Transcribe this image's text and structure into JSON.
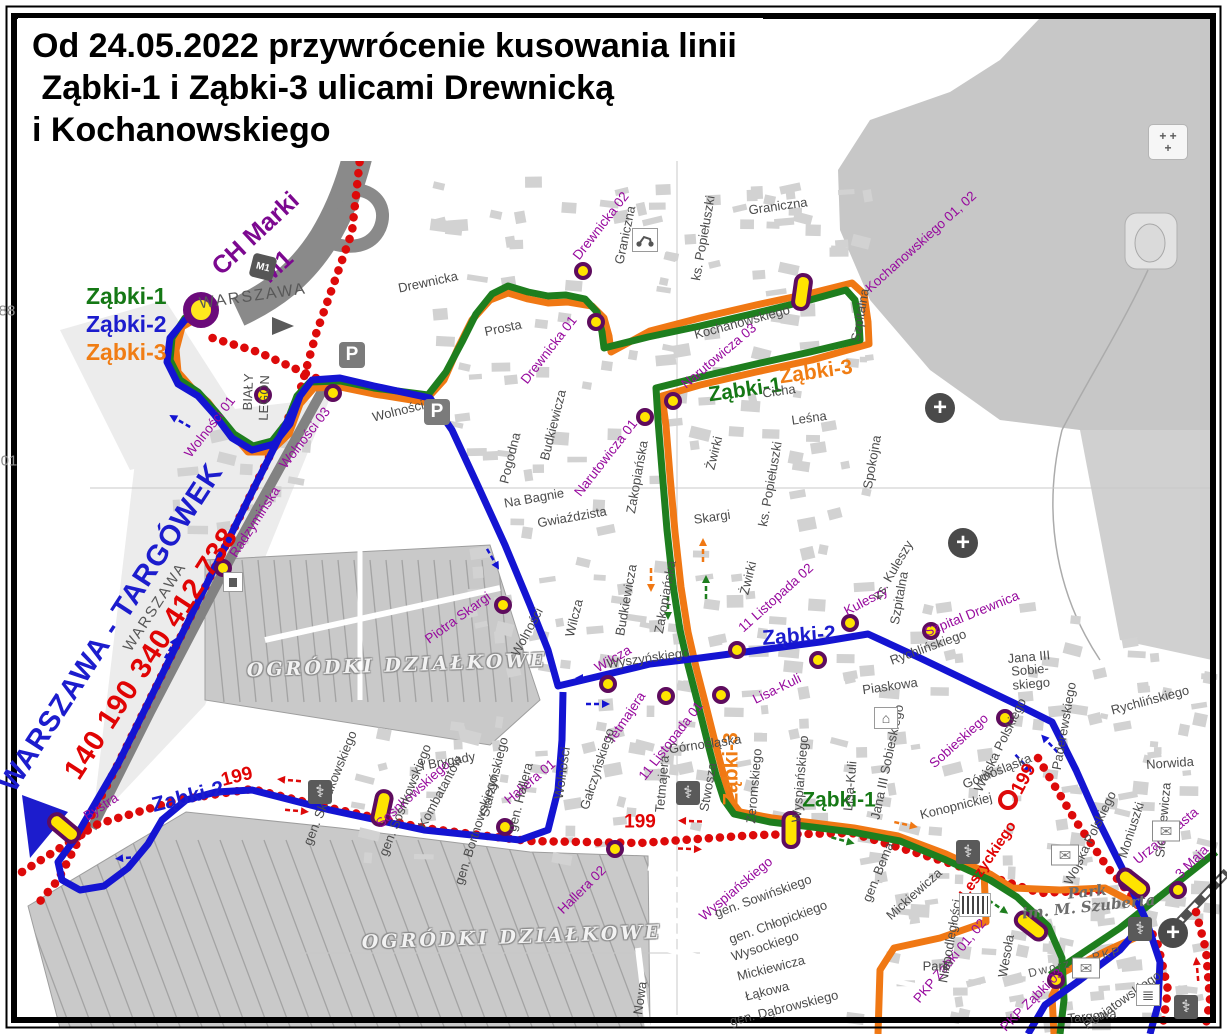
{
  "title": {
    "line1": "Od 24.05.2022 przywrócenie kusowania linii",
    "line2": " Ząbki-1 i Ząbki-3 ulicami Drewnicką",
    "line3": "i Kochanowskiego"
  },
  "legend": {
    "items": [
      {
        "label": "Ząbki-1",
        "color": "#157815"
      },
      {
        "label": "Ząbki-2",
        "color": "#1c1ccd"
      },
      {
        "label": "Ząbki-3",
        "color": "#f07d14"
      }
    ]
  },
  "colors": {
    "zabki1_green": "#1e7e1e",
    "zabki2_blue": "#1414d2",
    "zabki3_orange": "#f07814",
    "line199_red": "#dd0a0a",
    "stop_fill": "#ffe400",
    "stop_ring": "#5e0c5e",
    "terminal_fill": "#ffe81e",
    "terminal_ring": "#6b0b7b",
    "street_label": "#4b4b4b",
    "stop_label_purple": "#970a9e"
  },
  "map": {
    "labels": [
      {
        "t": "CH Marki",
        "x": 256,
        "y": 234,
        "r": -43,
        "c": "pub"
      },
      {
        "t": "M1",
        "x": 277,
        "y": 267,
        "r": -43,
        "c": "pub"
      },
      {
        "t": "WARSZAWA",
        "x": 253,
        "y": 297,
        "r": -8,
        "c": "dark"
      },
      {
        "t": "WARSZAWA",
        "x": 155,
        "y": 607,
        "r": -57,
        "c": "dark",
        "s": 15
      },
      {
        "t": "WARSZAWA - TARGÓWEK",
        "x": 112,
        "y": 628,
        "r": -57,
        "c": "bb"
      },
      {
        "t": "140 190 340 412 738",
        "x": 152,
        "y": 654,
        "r": -57,
        "c": "rb"
      },
      {
        "t": "Ząbki-2",
        "x": 188,
        "y": 797,
        "r": -14,
        "c": "bm"
      },
      {
        "t": "199",
        "x": 237,
        "y": 777,
        "r": -14,
        "c": "rm"
      },
      {
        "t": "Bystra",
        "x": 101,
        "y": 807,
        "r": -33,
        "c": "pu"
      },
      {
        "t": "199",
        "x": 640,
        "y": 822,
        "r": 0,
        "c": "rm"
      },
      {
        "t": "199",
        "x": 1024,
        "y": 779,
        "r": -62,
        "c": "rm"
      },
      {
        "t": "Ząbki-1",
        "x": 745,
        "y": 390,
        "r": -8,
        "c": "gm"
      },
      {
        "t": "Ząbki-3",
        "x": 816,
        "y": 372,
        "r": -8,
        "c": "om"
      },
      {
        "t": "Ząbki-2",
        "x": 799,
        "y": 636,
        "r": -4,
        "c": "bm"
      },
      {
        "t": "Ząbki-1",
        "x": 839,
        "y": 800,
        "r": 0,
        "c": "gm"
      },
      {
        "t": "Ząbki-3",
        "x": 731,
        "y": 769,
        "r": -90,
        "c": "om"
      },
      {
        "t": "Leszyckiego",
        "x": 988,
        "y": 860,
        "r": -56,
        "c": "rs"
      },
      {
        "t": "OGRÓDKI DZIAŁKOWE",
        "x": 397,
        "y": 666,
        "r": -2,
        "c": "area"
      },
      {
        "t": "OGRÓDKI DZIAŁKOWE",
        "x": 512,
        "y": 938,
        "r": -2,
        "c": "area"
      },
      {
        "t": "Park\nim. M. Szuberta",
        "x": 1088,
        "y": 900,
        "r": -6,
        "c": "park"
      },
      {
        "t": "Dworzec PKP",
        "x": 1075,
        "y": 962,
        "r": -14,
        "c": "dark",
        "s": 12
      },
      {
        "t": "88",
        "x": 7,
        "y": 311,
        "r": 0,
        "c": "grid"
      },
      {
        "t": "01",
        "x": 9,
        "y": 461,
        "r": 0,
        "c": "grid"
      },
      {
        "t": "BIAŁY",
        "x": 248,
        "y": 392,
        "r": -88,
        "c": "st"
      },
      {
        "t": "LEGON",
        "x": 264,
        "y": 398,
        "r": -88,
        "c": "st"
      },
      {
        "t": "Drewnicka 02",
        "x": 601,
        "y": 226,
        "r": -52,
        "c": "pu"
      },
      {
        "t": "Drewnicka 01",
        "x": 549,
        "y": 350,
        "r": -52,
        "c": "pu"
      },
      {
        "t": "Kochanowskiego 01, 02",
        "x": 921,
        "y": 242,
        "r": -42,
        "c": "pu"
      },
      {
        "t": "Narutowicza 03",
        "x": 719,
        "y": 356,
        "r": -40,
        "c": "pu"
      },
      {
        "t": "Narutowicza 01",
        "x": 606,
        "y": 458,
        "r": -52,
        "c": "pu"
      },
      {
        "t": "Wolności 01",
        "x": 210,
        "y": 427,
        "r": -52,
        "c": "pu"
      },
      {
        "t": "Wolności 03",
        "x": 305,
        "y": 438,
        "r": -52,
        "c": "pu"
      },
      {
        "t": "Radzymińska",
        "x": 255,
        "y": 522,
        "r": -57,
        "c": "pu"
      },
      {
        "t": "Piotra Skargi",
        "x": 458,
        "y": 618,
        "r": -36,
        "c": "pu"
      },
      {
        "t": "11 Listopada 02",
        "x": 776,
        "y": 598,
        "r": -42,
        "c": "pu"
      },
      {
        "t": "11 Listopada 01",
        "x": 671,
        "y": 741,
        "r": -52,
        "c": "pu"
      },
      {
        "t": "Wilcza",
        "x": 613,
        "y": 659,
        "r": -30,
        "c": "pu"
      },
      {
        "t": "Tetmajera",
        "x": 626,
        "y": 718,
        "r": -56,
        "c": "pu"
      },
      {
        "t": "Lisa-Kuli",
        "x": 777,
        "y": 689,
        "r": -26,
        "c": "pu"
      },
      {
        "t": "Kuleszy",
        "x": 866,
        "y": 601,
        "r": -28,
        "c": "pu"
      },
      {
        "t": "Szpital Drewnica",
        "x": 972,
        "y": 614,
        "r": -22,
        "c": "pu"
      },
      {
        "t": "Sobieskiego",
        "x": 959,
        "y": 741,
        "r": -42,
        "c": "pu"
      },
      {
        "t": "Sosnkowskiego",
        "x": 413,
        "y": 794,
        "r": -42,
        "c": "pu"
      },
      {
        "t": "Hallera 01",
        "x": 530,
        "y": 782,
        "r": -40,
        "c": "pu"
      },
      {
        "t": "Hallera 02",
        "x": 582,
        "y": 890,
        "r": -45,
        "c": "pu"
      },
      {
        "t": "Wyspiańskiego",
        "x": 736,
        "y": 889,
        "r": -40,
        "c": "pu"
      },
      {
        "t": "PKP Zabki 01, 02",
        "x": 950,
        "y": 961,
        "r": -50,
        "c": "pu"
      },
      {
        "t": "PKP Ząbki 03",
        "x": 1032,
        "y": 1000,
        "r": -45,
        "c": "pu"
      },
      {
        "t": "Urząd Miasta",
        "x": 1166,
        "y": 836,
        "r": -40,
        "c": "pu"
      },
      {
        "t": "3 Maja",
        "x": 1192,
        "y": 862,
        "r": -45,
        "c": "pu"
      },
      {
        "t": "Drewnicka",
        "x": 428,
        "y": 282,
        "r": -12,
        "c": "st"
      },
      {
        "t": "Prosta",
        "x": 503,
        "y": 328,
        "r": -12,
        "c": "st"
      },
      {
        "t": "Graniczna",
        "x": 625,
        "y": 235,
        "r": -78,
        "c": "st"
      },
      {
        "t": "Graniczna",
        "x": 778,
        "y": 206,
        "r": -8,
        "c": "st"
      },
      {
        "t": "ks. Popiełuszki",
        "x": 703,
        "y": 238,
        "r": -80,
        "c": "st"
      },
      {
        "t": "Kochanowskiego",
        "x": 742,
        "y": 322,
        "r": -15,
        "c": "st"
      },
      {
        "t": "Szpitalna",
        "x": 860,
        "y": 315,
        "r": -80,
        "c": "st"
      },
      {
        "t": "Cicha",
        "x": 779,
        "y": 391,
        "r": -8,
        "c": "st"
      },
      {
        "t": "Leśna",
        "x": 809,
        "y": 418,
        "r": -8,
        "c": "st"
      },
      {
        "t": "Spokojna",
        "x": 872,
        "y": 462,
        "r": -80,
        "c": "st"
      },
      {
        "t": "Żwirki",
        "x": 714,
        "y": 453,
        "r": -76,
        "c": "st"
      },
      {
        "t": "Żwirki",
        "x": 748,
        "y": 578,
        "r": -76,
        "c": "st"
      },
      {
        "t": "ks. Popiełuszki",
        "x": 770,
        "y": 484,
        "r": -80,
        "c": "st"
      },
      {
        "t": "Skargi",
        "x": 712,
        "y": 517,
        "r": -8,
        "c": "st"
      },
      {
        "t": "Budkiewicza",
        "x": 553,
        "y": 425,
        "r": -76,
        "c": "st"
      },
      {
        "t": "Budkiewicza",
        "x": 626,
        "y": 600,
        "r": -80,
        "c": "st"
      },
      {
        "t": "Pogodna",
        "x": 510,
        "y": 458,
        "r": -76,
        "c": "st"
      },
      {
        "t": "Na Bagnie",
        "x": 534,
        "y": 498,
        "r": -10,
        "c": "st"
      },
      {
        "t": "Gwiaździsta",
        "x": 572,
        "y": 517,
        "r": -10,
        "c": "st"
      },
      {
        "t": "Zakopiańska",
        "x": 637,
        "y": 477,
        "r": -80,
        "c": "st"
      },
      {
        "t": "Zakopiańska",
        "x": 665,
        "y": 597,
        "r": -80,
        "c": "st"
      },
      {
        "t": "Wilcza",
        "x": 574,
        "y": 618,
        "r": -76,
        "c": "st"
      },
      {
        "t": "Wyszyńskiego",
        "x": 648,
        "y": 658,
        "r": -8,
        "c": "st"
      },
      {
        "t": "ks. Kuleszy",
        "x": 893,
        "y": 570,
        "r": -60,
        "c": "st"
      },
      {
        "t": "Szpitalna",
        "x": 899,
        "y": 598,
        "r": -80,
        "c": "st"
      },
      {
        "t": "Rychlińskiego",
        "x": 928,
        "y": 647,
        "r": -20,
        "c": "st"
      },
      {
        "t": "Rychlińskiego",
        "x": 1150,
        "y": 700,
        "r": -15,
        "c": "st"
      },
      {
        "t": "Jana III\nSobie-\nskiego",
        "x": 1030,
        "y": 670,
        "r": -5,
        "c": "st"
      },
      {
        "t": "Paderewskiego",
        "x": 1064,
        "y": 726,
        "r": -80,
        "c": "st"
      },
      {
        "t": "Norwida",
        "x": 1170,
        "y": 763,
        "r": -4,
        "c": "st"
      },
      {
        "t": "Sienkiewicza",
        "x": 1163,
        "y": 820,
        "r": -85,
        "c": "st"
      },
      {
        "t": "Moniuszki",
        "x": 1131,
        "y": 830,
        "r": -72,
        "c": "st"
      },
      {
        "t": "Piaskowa",
        "x": 890,
        "y": 686,
        "r": -8,
        "c": "st"
      },
      {
        "t": "Lisa-Kuli",
        "x": 850,
        "y": 786,
        "r": -85,
        "c": "st"
      },
      {
        "t": "Wyspiańskiego",
        "x": 800,
        "y": 779,
        "r": -85,
        "c": "st"
      },
      {
        "t": "Żeromskiego",
        "x": 754,
        "y": 786,
        "r": -85,
        "c": "st"
      },
      {
        "t": "Jana III Sobieskiego",
        "x": 887,
        "y": 762,
        "r": -78,
        "c": "st"
      },
      {
        "t": "Górnośląska",
        "x": 705,
        "y": 744,
        "r": -8,
        "c": "st"
      },
      {
        "t": "Górnośląska",
        "x": 997,
        "y": 771,
        "r": -22,
        "c": "st"
      },
      {
        "t": "Konopnickiej",
        "x": 956,
        "y": 806,
        "r": -14,
        "c": "st"
      },
      {
        "t": "Stwosza",
        "x": 708,
        "y": 787,
        "r": -80,
        "c": "st"
      },
      {
        "t": "Tetmajera",
        "x": 662,
        "y": 784,
        "r": -85,
        "c": "st"
      },
      {
        "t": "Gałczyńskiego",
        "x": 597,
        "y": 769,
        "r": -72,
        "c": "st"
      },
      {
        "t": "Wolności",
        "x": 527,
        "y": 632,
        "r": -62,
        "c": "st"
      },
      {
        "t": "Wolności",
        "x": 562,
        "y": 773,
        "r": -82,
        "c": "st"
      },
      {
        "t": "Wolności",
        "x": 398,
        "y": 411,
        "r": -14,
        "c": "st"
      },
      {
        "t": "gen. Składkowskiego",
        "x": 330,
        "y": 788,
        "r": -68,
        "c": "st"
      },
      {
        "t": "gen. Sosnkowskiego",
        "x": 405,
        "y": 800,
        "r": -68,
        "c": "st"
      },
      {
        "t": "I Brygady",
        "x": 448,
        "y": 761,
        "r": -10,
        "c": "st"
      },
      {
        "t": "Kombatantów",
        "x": 440,
        "y": 792,
        "r": -62,
        "c": "st"
      },
      {
        "t": "gen. Bortnowskiego",
        "x": 476,
        "y": 830,
        "r": -72,
        "c": "st"
      },
      {
        "t": "Starzyńskiego",
        "x": 494,
        "y": 777,
        "r": -76,
        "c": "st"
      },
      {
        "t": "gen. Hallera",
        "x": 520,
        "y": 797,
        "r": -76,
        "c": "st"
      },
      {
        "t": "Wojska Polskiego",
        "x": 1000,
        "y": 745,
        "r": -64,
        "c": "st"
      },
      {
        "t": "Wojska Polskiego",
        "x": 1090,
        "y": 838,
        "r": -64,
        "c": "st"
      },
      {
        "t": "gen. Bema",
        "x": 878,
        "y": 872,
        "r": -68,
        "c": "st"
      },
      {
        "t": "Mickiewicza",
        "x": 914,
        "y": 894,
        "r": -42,
        "c": "st"
      },
      {
        "t": "Niepodległości",
        "x": 950,
        "y": 941,
        "r": -80,
        "c": "st"
      },
      {
        "t": "Park",
        "x": 936,
        "y": 966,
        "r": 0,
        "c": "st"
      },
      {
        "t": "Wesoła",
        "x": 1006,
        "y": 956,
        "r": -80,
        "c": "st"
      },
      {
        "t": "gen. Sowińskiego",
        "x": 763,
        "y": 896,
        "r": -20,
        "c": "st"
      },
      {
        "t": "gen. Chłopickiego",
        "x": 778,
        "y": 922,
        "r": -20,
        "c": "st"
      },
      {
        "t": "Wysockiego",
        "x": 765,
        "y": 946,
        "r": -18,
        "c": "st"
      },
      {
        "t": "Mickiewicza",
        "x": 771,
        "y": 968,
        "r": -14,
        "c": "st"
      },
      {
        "t": "Łąkowa",
        "x": 767,
        "y": 991,
        "r": -14,
        "c": "st"
      },
      {
        "t": "gen. Dąbrowskiego",
        "x": 784,
        "y": 1008,
        "r": -14,
        "c": "st"
      },
      {
        "t": "Nowa",
        "x": 640,
        "y": 998,
        "r": -82,
        "c": "st"
      },
      {
        "t": "Targowa",
        "x": 1092,
        "y": 1016,
        "r": -6,
        "c": "st"
      },
      {
        "t": "Poniatowskiego",
        "x": 1122,
        "y": 1000,
        "r": -35,
        "c": "st"
      }
    ],
    "stops": [
      {
        "x": 263,
        "y": 395
      },
      {
        "x": 333,
        "y": 393
      },
      {
        "x": 223,
        "y": 568
      },
      {
        "x": 583,
        "y": 271
      },
      {
        "x": 596,
        "y": 322
      },
      {
        "x": 645,
        "y": 417
      },
      {
        "x": 673,
        "y": 401
      },
      {
        "x": 503,
        "y": 605
      },
      {
        "x": 505,
        "y": 827
      },
      {
        "x": 615,
        "y": 849
      },
      {
        "x": 608,
        "y": 684
      },
      {
        "x": 666,
        "y": 696
      },
      {
        "x": 721,
        "y": 695
      },
      {
        "x": 737,
        "y": 650
      },
      {
        "x": 818,
        "y": 660
      },
      {
        "x": 850,
        "y": 623
      },
      {
        "x": 931,
        "y": 631
      },
      {
        "x": 1005,
        "y": 718
      },
      {
        "x": 1127,
        "y": 882
      },
      {
        "x": 1178,
        "y": 890
      },
      {
        "x": 1056,
        "y": 980
      }
    ],
    "stop_bays": [
      {
        "x": 64,
        "y": 828,
        "r": -50
      },
      {
        "x": 382,
        "y": 808,
        "r": 12
      },
      {
        "x": 802,
        "y": 292,
        "r": 8
      },
      {
        "x": 791,
        "y": 830,
        "r": 0
      },
      {
        "x": 1133,
        "y": 883,
        "r": -52
      },
      {
        "x": 1031,
        "y": 926,
        "r": -52
      }
    ],
    "terminal": {
      "x": 201,
      "y": 310
    },
    "ring199": {
      "x": 1008,
      "y": 800
    },
    "icons": [
      {
        "k": "parking",
        "x": 352,
        "y": 355
      },
      {
        "k": "parking",
        "x": 437,
        "y": 412
      },
      {
        "k": "m1",
        "x": 263,
        "y": 267
      },
      {
        "k": "moto",
        "x": 645,
        "y": 240
      },
      {
        "k": "plus",
        "x": 940,
        "y": 408
      },
      {
        "k": "plus",
        "x": 963,
        "y": 543
      },
      {
        "k": "plus",
        "x": 1173,
        "y": 933
      },
      {
        "k": "pharmacy",
        "x": 320,
        "y": 792
      },
      {
        "k": "pharmacy",
        "x": 688,
        "y": 793
      },
      {
        "k": "pharmacy",
        "x": 968,
        "y": 852
      },
      {
        "k": "pharmacy",
        "x": 1140,
        "y": 929
      },
      {
        "k": "pharmacy",
        "x": 1186,
        "y": 1007
      },
      {
        "k": "mail",
        "x": 1065,
        "y": 855
      },
      {
        "k": "mail",
        "x": 1086,
        "y": 968
      },
      {
        "k": "mail",
        "x": 1166,
        "y": 831
      },
      {
        "k": "school",
        "x": 886,
        "y": 718
      },
      {
        "k": "shelter",
        "x": 233,
        "y": 582
      },
      {
        "k": "books",
        "x": 1148,
        "y": 995
      },
      {
        "k": "barcode",
        "x": 975,
        "y": 905
      },
      {
        "k": "cemetery",
        "x": 1168,
        "y": 142
      }
    ],
    "arrows": [
      {
        "x": 172,
        "y": 646,
        "a": 60,
        "c": "blue"
      },
      {
        "x": 125,
        "y": 858,
        "a": 185,
        "c": "blue"
      },
      {
        "x": 494,
        "y": 561,
        "a": -60,
        "c": "blue"
      },
      {
        "x": 585,
        "y": 678,
        "a": 180,
        "c": "blue"
      },
      {
        "x": 600,
        "y": 704,
        "a": 0,
        "c": "blue"
      },
      {
        "x": 1048,
        "y": 742,
        "a": 133,
        "c": "blue"
      },
      {
        "x": 1025,
        "y": 765,
        "a": -47,
        "c": "blue"
      },
      {
        "x": 178,
        "y": 420,
        "a": 150,
        "c": "blue"
      },
      {
        "x": 287,
        "y": 780,
        "a": 175,
        "c": "red"
      },
      {
        "x": 299,
        "y": 811,
        "a": -5,
        "c": "red"
      },
      {
        "x": 688,
        "y": 821,
        "a": 178,
        "c": "red"
      },
      {
        "x": 692,
        "y": 849,
        "a": -2,
        "c": "red"
      },
      {
        "x": 1197,
        "y": 967,
        "a": 95,
        "c": "red"
      },
      {
        "x": 908,
        "y": 825,
        "a": -12,
        "c": "orange"
      },
      {
        "x": 651,
        "y": 582,
        "a": -90,
        "c": "orange"
      },
      {
        "x": 703,
        "y": 548,
        "a": 90,
        "c": "orange"
      },
      {
        "x": 845,
        "y": 841,
        "a": -15,
        "c": "green"
      },
      {
        "x": 1000,
        "y": 908,
        "a": -35,
        "c": "green"
      },
      {
        "x": 668,
        "y": 610,
        "a": -90,
        "c": "green"
      },
      {
        "x": 706,
        "y": 585,
        "a": 90,
        "c": "green"
      }
    ]
  }
}
